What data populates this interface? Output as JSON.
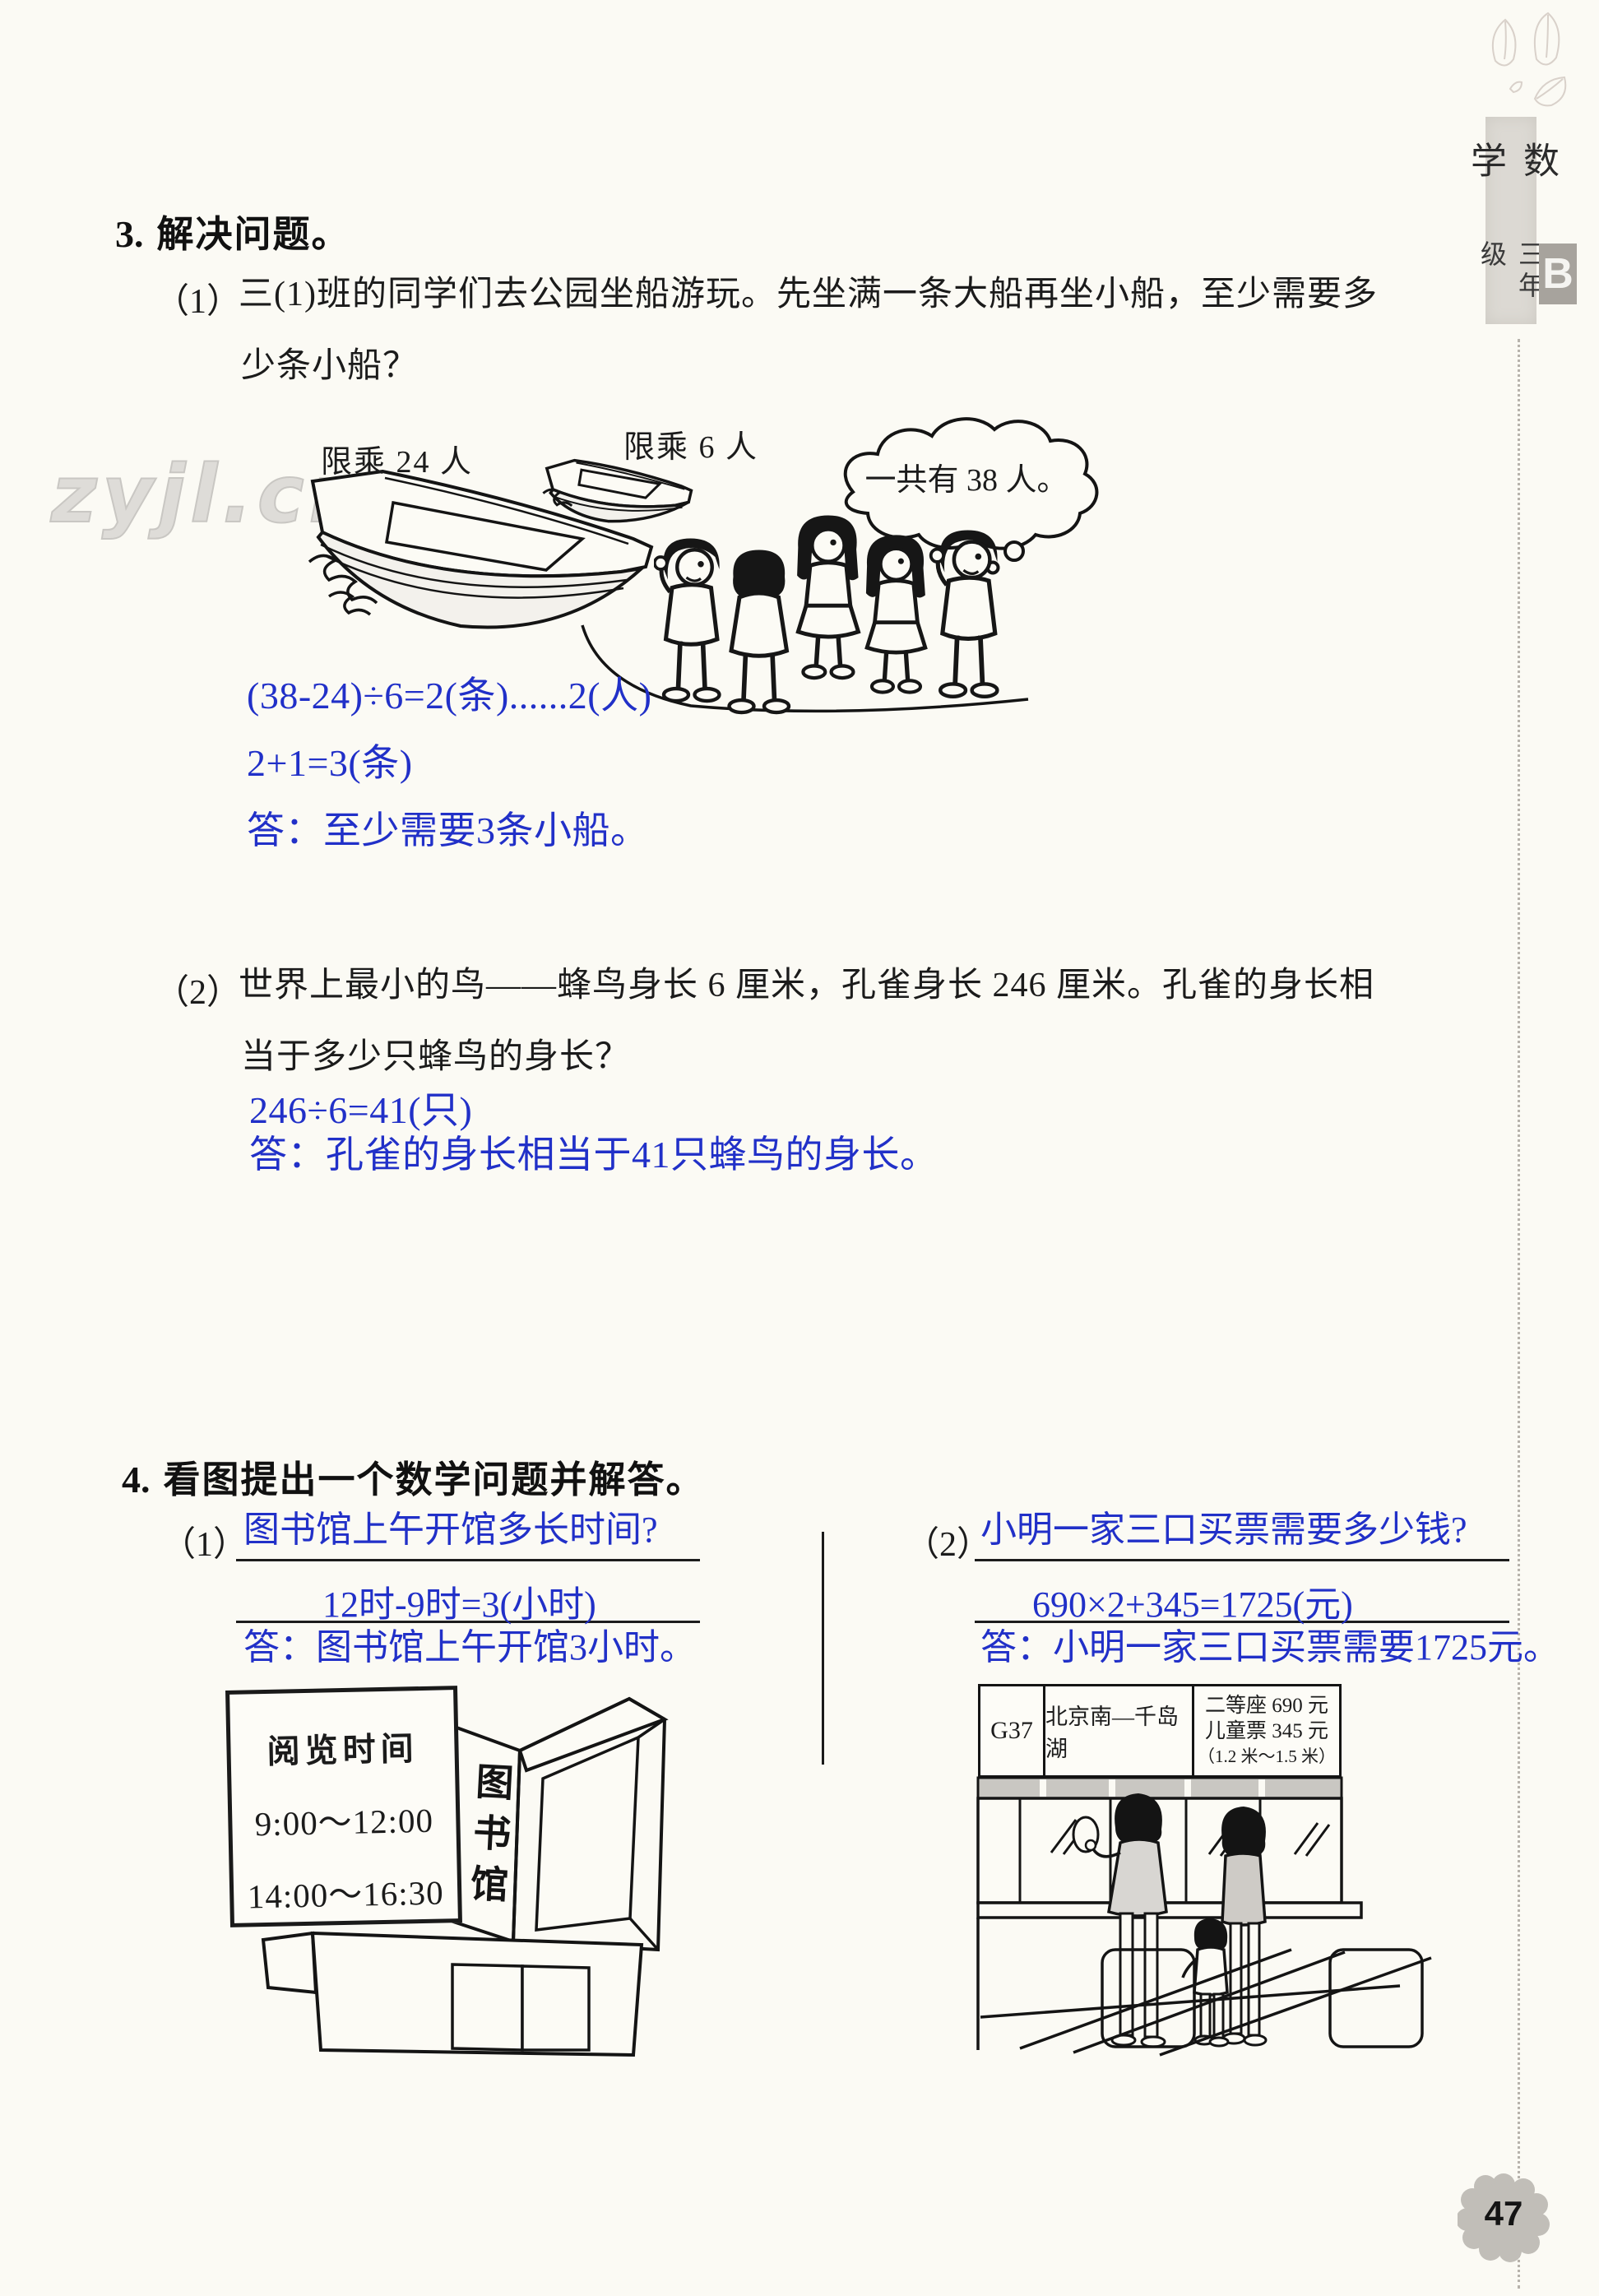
{
  "page": {
    "number": "47",
    "watermark": "zyjl.cn",
    "sidebar": {
      "subject": "数学",
      "grade": "三年级",
      "level": "B"
    }
  },
  "q3": {
    "number": "3.",
    "title": "解决问题。",
    "p1": {
      "label": "（1）",
      "line1": "三(1)班的同学们去公园坐船游玩。先坐满一条大船再坐小船，至少需要多",
      "line2": "少条小船？",
      "big_boat_label": "限乘 24 人",
      "small_boat_label": "限乘 6 人",
      "bubble": "一共有 38 人。",
      "answer1": "(38-24)÷6=2(条)......2(人)",
      "answer2": "2+1=3(条)",
      "answer3": "答：至少需要3条小船。"
    },
    "p2": {
      "label": "（2）",
      "line1": "世界上最小的鸟——蜂鸟身长 6 厘米，孔雀身长 246 厘米。孔雀的身长相",
      "line2": "当于多少只蜂鸟的身长？",
      "answer1": "246÷6=41(只)",
      "answer2": "答：孔雀的身长相当于41只蜂鸟的身长。"
    }
  },
  "q4": {
    "number": "4.",
    "title": "看图提出一个数学问题并解答。",
    "p1": {
      "label": "（1）",
      "question": "图书馆上午开馆多长时间?",
      "equation": "12时-9时=3(小时)",
      "answer": "答：图书馆上午开馆3小时。",
      "sign_title": "阅览时间",
      "sign_line1": "9:00～12:00",
      "sign_line2": "14:00～16:30",
      "building_label": "图书馆"
    },
    "p2": {
      "label": "（2）",
      "question": "小明一家三口买票需要多少钱?",
      "equation": "690×2+345=1725(元)",
      "answer": "答：小明一家三口买票需要1725元。",
      "train_no": "G37",
      "route": "北京南—千岛湖",
      "price1": "二等座 690 元",
      "price2": "儿童票 345 元",
      "price3": "（1.2 米～1.5 米）"
    }
  }
}
